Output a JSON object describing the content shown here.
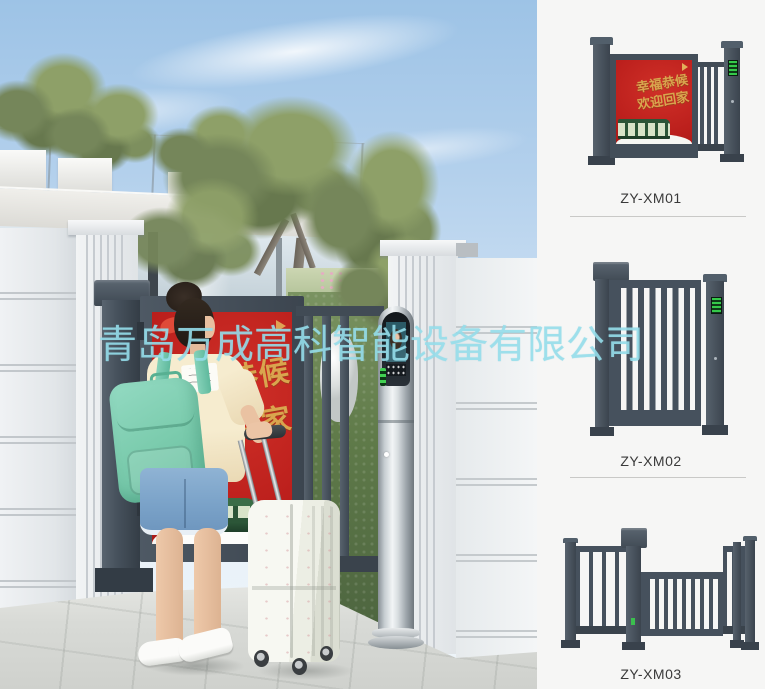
{
  "watermark": {
    "text": "青岛万成高科智能设备有限公司"
  },
  "scene": {
    "poster": {
      "line1": "幸福恭候",
      "line2": "欢迎回家"
    }
  },
  "panel": {
    "products": [
      {
        "label": "ZY-XM01"
      },
      {
        "label": "ZY-XM02"
      },
      {
        "label": "ZY-XM03"
      }
    ]
  },
  "colors": {
    "gate_dark": "#46515d",
    "poster_red": "#c1211e",
    "poster_gold": "#d9a54e",
    "watermark_cyan": "#96dceb",
    "panel_bg": "#f6f6f5",
    "backpack_mint": "#7ecdb4"
  }
}
